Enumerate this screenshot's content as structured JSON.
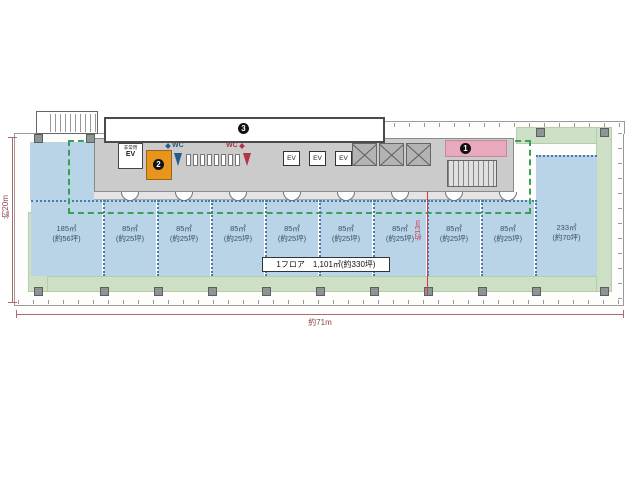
{
  "rooms": [
    {
      "area": "185㎡",
      "tsubo": "(約56坪)"
    },
    {
      "area": "85㎡",
      "tsubo": "(約25坪)"
    },
    {
      "area": "85㎡",
      "tsubo": "(約25坪)"
    },
    {
      "area": "85㎡",
      "tsubo": "(約25坪)"
    },
    {
      "area": "85㎡",
      "tsubo": "(約25坪)"
    },
    {
      "area": "85㎡",
      "tsubo": "(約25坪)"
    },
    {
      "area": "85㎡",
      "tsubo": "(約25坪)"
    },
    {
      "area": "85㎡",
      "tsubo": "(約25坪)"
    },
    {
      "area": "85㎡",
      "tsubo": "(約25坪)"
    },
    {
      "area": "233㎡",
      "tsubo": "(約70坪)"
    }
  ],
  "summary": {
    "floor_label": "1フロア",
    "value": "1,101㎡(約330坪)"
  },
  "dimensions": {
    "width": "約71m",
    "left": "約20m",
    "depth": "約13m"
  },
  "core": {
    "emergency_ev_line1": "非常用",
    "emergency_ev_line2": "EV",
    "ev_label": "EV",
    "wc_men": "WC",
    "wc_women": "WC",
    "marker1": "1",
    "marker2": "2",
    "marker3": "3"
  },
  "colors": {
    "room_blue": "#b9d4e7",
    "balcony_green": "#cde0c6",
    "core_gray": "#cbcbcb",
    "pink": "#e8a9bc",
    "orange": "#e8951e",
    "lease_dash": "#3aa055",
    "partition_dot": "#4a7ab0",
    "dimension_red": "#a85858",
    "depth_red": "#cc3a4e"
  }
}
